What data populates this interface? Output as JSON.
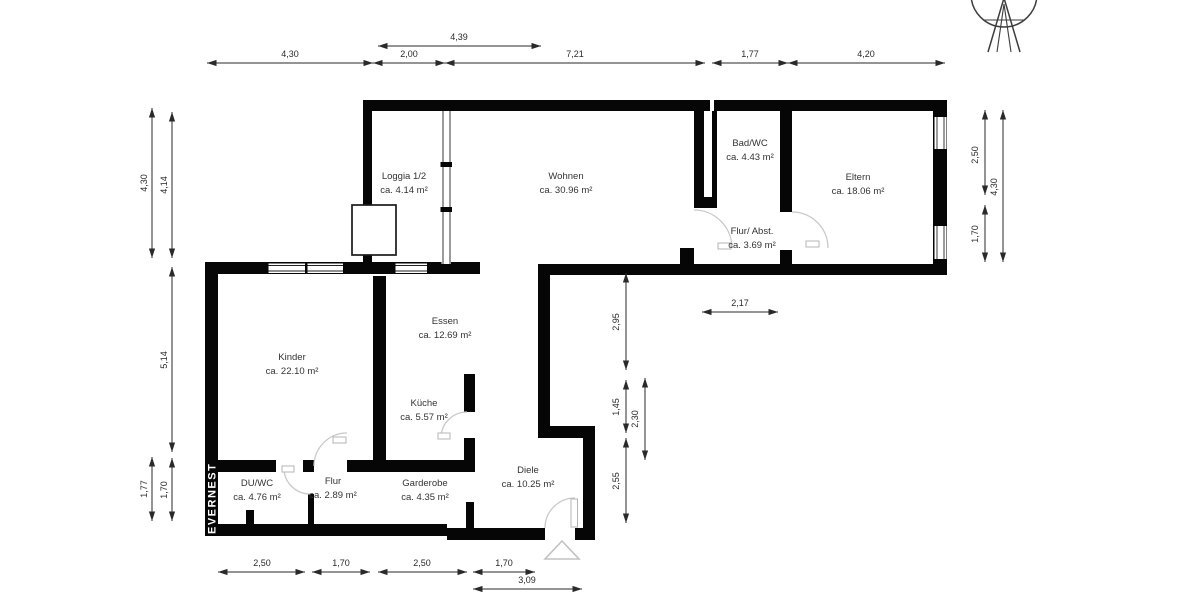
{
  "branding": {
    "name": "EVERNEST",
    "logo_icon": "drafting-compass-circle-icon"
  },
  "colors": {
    "wall": "#060606",
    "dimension": "#2a2a2a",
    "door_arc": "#c9c9c9",
    "entrance_marker": "#c2c2c2",
    "label_text": "#333333",
    "brand_text": "#ffffff",
    "background": "#ffffff"
  },
  "rooms": [
    {
      "id": "loggia",
      "name": "Loggia 1/2",
      "area": "ca. 4.14 m²",
      "x": 404,
      "y": 179
    },
    {
      "id": "wohnen",
      "name": "Wohnen",
      "area": "ca. 30.96 m²",
      "x": 566,
      "y": 179
    },
    {
      "id": "bad-wc",
      "name": "Bad/WC",
      "area": "ca. 4.43 m²",
      "x": 750,
      "y": 146
    },
    {
      "id": "eltern",
      "name": "Eltern",
      "area": "ca. 18.06 m²",
      "x": 858,
      "y": 180
    },
    {
      "id": "flur-abst",
      "name": "Flur/ Abst.",
      "area": "ca. 3.69 m²",
      "x": 752,
      "y": 234
    },
    {
      "id": "kinder",
      "name": "Kinder",
      "area": "ca. 22.10 m²",
      "x": 292,
      "y": 360
    },
    {
      "id": "essen",
      "name": "Essen",
      "area": "ca. 12.69 m²",
      "x": 445,
      "y": 324
    },
    {
      "id": "kueche",
      "name": "Küche",
      "area": "ca. 5.57 m²",
      "x": 424,
      "y": 406
    },
    {
      "id": "du-wc",
      "name": "DU/WC",
      "area": "ca. 4.76 m²",
      "x": 257,
      "y": 486
    },
    {
      "id": "flur",
      "name": "Flur",
      "area": "ca. 2.89 m²",
      "x": 333,
      "y": 484
    },
    {
      "id": "garderobe",
      "name": "Garderobe",
      "area": "ca. 4.35 m²",
      "x": 425,
      "y": 486
    },
    {
      "id": "diele",
      "name": "Diele",
      "area": "ca. 10.25 m²",
      "x": 528,
      "y": 473
    }
  ],
  "dimensions": [
    {
      "label": "4,39",
      "x1": 378,
      "y1": 46,
      "x2": 541,
      "y2": 46,
      "lx": 459,
      "ly": 40,
      "vert": false
    },
    {
      "label": "4,30",
      "x1": 207,
      "y1": 63,
      "x2": 373,
      "y2": 63,
      "lx": 290,
      "ly": 57,
      "vert": false
    },
    {
      "label": "2,00",
      "x1": 373,
      "y1": 63,
      "x2": 445,
      "y2": 63,
      "lx": 409,
      "ly": 57,
      "vert": false
    },
    {
      "label": "7,21",
      "x1": 445,
      "y1": 63,
      "x2": 705,
      "y2": 63,
      "lx": 575,
      "ly": 57,
      "vert": false
    },
    {
      "label": "1,77",
      "x1": 712,
      "y1": 63,
      "x2": 788,
      "y2": 63,
      "lx": 750,
      "ly": 57,
      "vert": false
    },
    {
      "label": "4,20",
      "x1": 788,
      "y1": 63,
      "x2": 945,
      "y2": 63,
      "lx": 866,
      "ly": 57,
      "vert": false
    },
    {
      "label": "4,30",
      "x1": 152,
      "y1": 108,
      "x2": 152,
      "y2": 258,
      "lx": 147,
      "ly": 183,
      "vert": true
    },
    {
      "label": "4,14",
      "x1": 172,
      "y1": 112,
      "x2": 172,
      "y2": 258,
      "lx": 167,
      "ly": 185,
      "vert": true
    },
    {
      "label": "5,14",
      "x1": 172,
      "y1": 267,
      "x2": 172,
      "y2": 452,
      "lx": 167,
      "ly": 360,
      "vert": true
    },
    {
      "label": "1,77",
      "x1": 152,
      "y1": 457,
      "x2": 152,
      "y2": 521,
      "lx": 147,
      "ly": 489,
      "vert": true
    },
    {
      "label": "1,70",
      "x1": 172,
      "y1": 458,
      "x2": 172,
      "y2": 521,
      "lx": 167,
      "ly": 490,
      "vert": true
    },
    {
      "label": "2,50",
      "x1": 985,
      "y1": 110,
      "x2": 985,
      "y2": 195,
      "lx": 978,
      "ly": 155,
      "vert": true
    },
    {
      "label": "1,70",
      "x1": 985,
      "y1": 205,
      "x2": 985,
      "y2": 262,
      "lx": 978,
      "ly": 234,
      "vert": true
    },
    {
      "label": "4,30",
      "x1": 1003,
      "y1": 110,
      "x2": 1003,
      "y2": 262,
      "lx": 997,
      "ly": 187,
      "vert": true
    },
    {
      "label": "2,95",
      "x1": 626,
      "y1": 273,
      "x2": 626,
      "y2": 370,
      "lx": 619,
      "ly": 322,
      "vert": true
    },
    {
      "label": "1,45",
      "x1": 626,
      "y1": 380,
      "x2": 626,
      "y2": 433,
      "lx": 619,
      "ly": 407,
      "vert": true
    },
    {
      "label": "2,30",
      "x1": 645,
      "y1": 378,
      "x2": 645,
      "y2": 460,
      "lx": 638,
      "ly": 419,
      "vert": true
    },
    {
      "label": "2,55",
      "x1": 626,
      "y1": 438,
      "x2": 626,
      "y2": 523,
      "lx": 619,
      "ly": 481,
      "vert": true
    },
    {
      "label": "2,17",
      "x1": 702,
      "y1": 312,
      "x2": 778,
      "y2": 312,
      "lx": 740,
      "ly": 306,
      "vert": false
    },
    {
      "label": "2,50",
      "x1": 218,
      "y1": 572,
      "x2": 305,
      "y2": 572,
      "lx": 262,
      "ly": 566,
      "vert": false
    },
    {
      "label": "1,70",
      "x1": 312,
      "y1": 572,
      "x2": 370,
      "y2": 572,
      "lx": 341,
      "ly": 566,
      "vert": false
    },
    {
      "label": "2,50",
      "x1": 378,
      "y1": 572,
      "x2": 467,
      "y2": 572,
      "lx": 422,
      "ly": 566,
      "vert": false
    },
    {
      "label": "1,70",
      "x1": 473,
      "y1": 572,
      "x2": 535,
      "y2": 572,
      "lx": 504,
      "ly": 566,
      "vert": false
    },
    {
      "label": "3,09",
      "x1": 473,
      "y1": 589,
      "x2": 582,
      "y2": 589,
      "lx": 527,
      "ly": 583,
      "vert": false
    }
  ]
}
